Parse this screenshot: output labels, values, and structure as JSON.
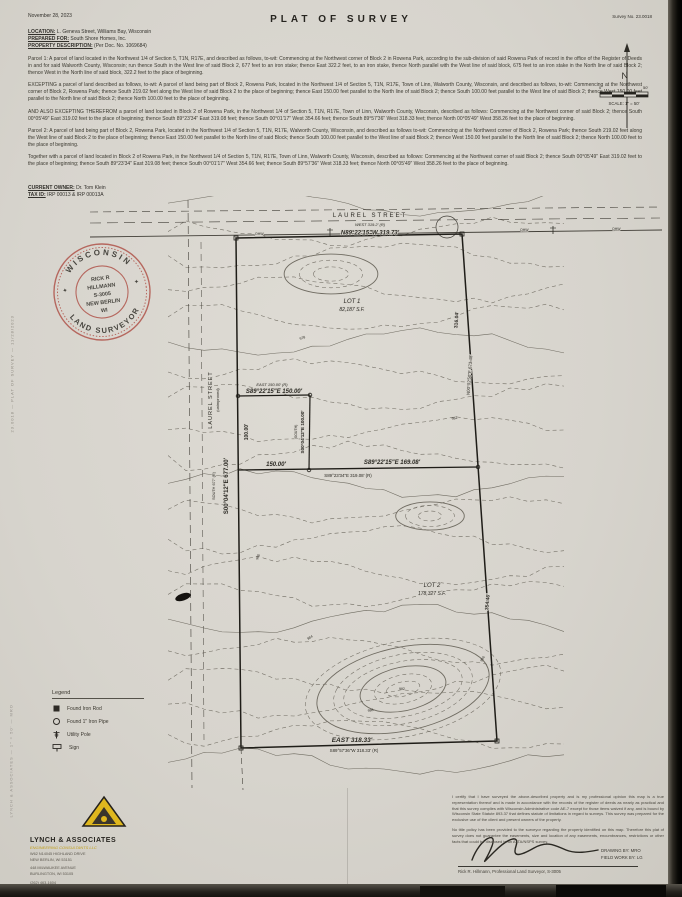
{
  "header": {
    "date": "November 28, 2023",
    "title": "PLAT  OF  SURVEY",
    "survey_no": "Survey No. 23.0018",
    "location_label": "LOCATION:",
    "location": "L. Geneva Street, Williams Bay, Wisconsin",
    "prepared_label": "PREPARED FOR:",
    "prepared": "South Shore Homes, Inc.",
    "property_label": "PROPERTY DESCRIPTION:",
    "property": "(Per Doc. No. 1069684)"
  },
  "description": {
    "p1": "Parcel 1: A parcel of land located in the Northwest 1/4 of Section 5, T1N, R17E, and described as follows, to-wit: Commencing at the Northwest corner of Block 2 in Rowena Park, according to the sub-division of said Rowena Park of record in the office of the Register of Deeds in and for said Walworth County, Wisconsin; run thence South in the West line of said Block 2, 677 feet to an iron stake; thence East 322.2 feet, to an iron stake, thence North parallel with the West line of said block, 675 feet to an iron stake in the North line of said Block 2; thence West in the North line of said block, 322.2 feet to the place of beginning.",
    "p2": "EXCEPTING a parcel of land described as follows, to-wit: A parcel of land being part of Block 2, Rowena Park, located in the Northwest 1/4 of Section 5, T1N, R17E, Town of Linn, Walworth County, Wisconsin, and described as follows, to-wit: Commencing at the Northwest corner of Block 2, Rowena Park; thence South 219.02 feet along the West line of said Block 2 to the place of beginning; thence East 150.00 feet parallel to the North line of said Block 2; thence South 100.00 feet parallel to the West line of said Block 2; thence West 150.00 feet parallel to the North line of said Block 2; thence North 100.00 feet to the place of beginning.",
    "p3": "AND ALSO EXCEPTING THEREFROM a parcel of land located in Block 2 of Rowena Park, in the Northwest 1/4 of Section 5, T1N, R17E, Town of Linn, Walworth County, Wisconsin, described as follows: Commencing at the Northwest corner of said Block 2; thence South 00°05'49\" East 319.02 feet to the place of beginning; thence South 89°23'34\" East 319.08 feet; thence South 00°01'17\" West 354.66 feet; thence South 89°57'36\" West 318.33 feet; thence North 00°05'49\" West 358.26 feet to the place of beginning.",
    "p4": "Parcel 2: A parcel of land being part of Block 2, Rowena Park, located in the Northwest 1/4 of Section 5, T1N, R17E, Walworth County, Wisconsin, and described as follows to-wit: Commencing at the Northwest corner of Block 2, Rowena Park; thence South 219.02 feet along the West line of said Block 2 to the place of beginning; thence East 150.00 feet parallel to the North line of said Block; thence South 100.00 feet parallel to the West line of said Block 2; thence West 150.00 feet parallel to the North line of said Block 2; thence North 100.00 feet to the place of beginning.",
    "p5": "Together with a parcel of land located in Block 2 of Rowena Park, in the Northwest 1/4 of Section 5, T1N, R17E, Town of Linn, Walworth County, Wisconsin, described as follows: Commencing at the Northwest corner of said Block 2; thence South 00°05'49\" East 319.02 feet to the place of beginning; thence South 89°23'34\" East 319.08 feet; thence South 00°01'17\" West 354.66 feet; thence South 89°57'36\" West 318.33 feet; thence North 00°05'49\" West 358.26 feet to the place of beginning.",
    "owner_label": "CURRENT OWNER:",
    "owner": "Dr. Tom Klein",
    "tax_label": "TAX ID:",
    "tax": "IRP 00013 & IRP 00013A"
  },
  "stamp": {
    "arc_top": "WISCONSIN",
    "arc_bottom": "LAND SURVEYOR",
    "line1": "RICK R",
    "line2": "HILLMANN",
    "line3": "S-3005",
    "line4": "NEW BERLIN",
    "line5": "WI",
    "color": "#b0544b"
  },
  "compass": {
    "n": "N",
    "zero": "0",
    "fifty": "50'",
    "scale_label": "SCALE: 1\" = 50'"
  },
  "map": {
    "street_top": "LAUREL STREET",
    "top_record": "WEST  319.2' (R)",
    "top_bearing": "N89°22'15\"W    319.73'",
    "ohw": "OHW",
    "street_left": "LAUREL STREET",
    "street_left_sub": "(unimproved)",
    "west_record": "SOUTH 677' (R)",
    "west_bearing": "S00°04'12\"E   677.00'",
    "inset_west_len": "100.00'",
    "inset_top_record": "EAST  150.00' (R)",
    "inset_top_bearing": "S89°22'15\"E   150.00'",
    "inset_east_record": "(SOUTH)",
    "inset_east_bearing": "S00°04'12\"E 100.00'",
    "mid_left_len": "150.00'",
    "mid_bearing": "S89°22'15\"E    169.08'",
    "mid_record": "S89°23'34\"E   319.08' (R)",
    "lot1": "LOT 1",
    "lot1_area": "82,187 S.F.",
    "lot2": "LOT 2",
    "lot2_area": "178,327 S.F.",
    "east_len_upper": "316.04'",
    "east_bearing": "N00°02'50\"E  673.48'",
    "east_len_lower": "354.46'",
    "bottom_bearing": "EAST     318.33'",
    "bottom_record": "S89°57'36\"W  318.33' (R)",
    "elev": [
      "978",
      "980",
      "982",
      "984",
      "986",
      "988",
      "992"
    ]
  },
  "legend": {
    "title": "Legend",
    "items": [
      {
        "icon": "found-iron-rod-icon",
        "label": "Found Iron Rod"
      },
      {
        "icon": "found-iron-pipe-icon",
        "label": "Found 1\" Iron Pipe"
      },
      {
        "icon": "utility-pole-icon",
        "label": "Utility Pole"
      },
      {
        "icon": "sign-icon",
        "label": "Sign"
      }
    ]
  },
  "footer": {
    "company_name": "LYNCH & ASSOCIATES",
    "company_tagline": "ENGINEERING CONSULTANTS LLC",
    "addr1": "W62 N14045 HIGHLAND DRIVE",
    "addr2": "NEW BERLIN, WI 53151",
    "addr3": "448 MILWAUKEE AVENUE",
    "addr4": "BURLINGTON, WI 53105",
    "phone": "(262) 463-1604",
    "cert1": "I certify that I have surveyed the above-described property and is my professional opinion this map is a true representation thereof and is made in accordance with the records of the register of deeds as nearly as practical and that this survey complies with Wisconsin Administrative code AE-7 except for those items waived if any, and is bound by Wisconsin State Statute 893.37 that defines statute of limitations in regard to surveys. This survey was prepared for the exclusive use of the client and present owners of the property.",
    "cert2": "No title policy has been provided to the surveyor regarding the property identified on this map. Therefore this plat of survey does not guarantee the easements, size and location of any easements, encumbrances, restrictions or other facts that could be disclosed in an ALTA/NSPS survey.",
    "surveyor_line": "Rick R. Hillmann, Professional Land Surveyor, S-3005",
    "drawing_by": "DRAWING BY: MRO",
    "field_by": "FIELD WORK BY: LG"
  },
  "edge": {
    "side_text": "23.0018  —  PLAT OF SURVEY  —  11/28/2023",
    "side_text2": "LYNCH & ASSOCIATES  —  1\" = 50'  —  MRO"
  }
}
